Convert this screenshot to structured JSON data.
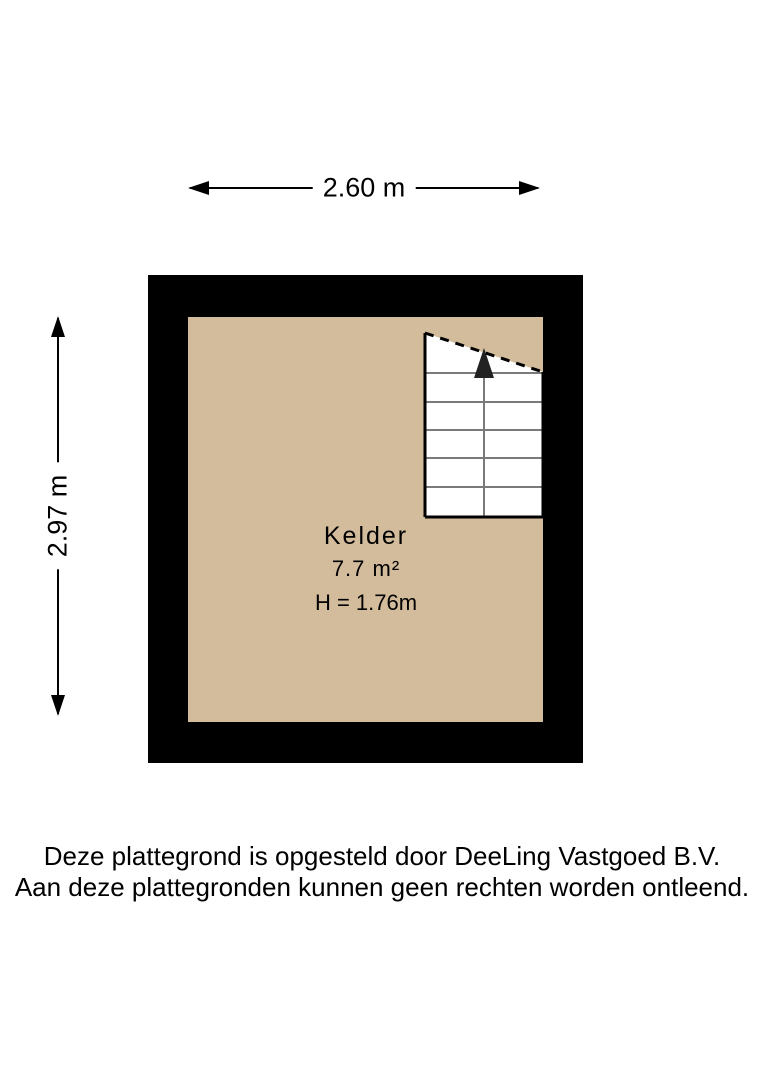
{
  "dimensions": {
    "width_label": "2.60 m",
    "height_label": "2.97 m"
  },
  "room": {
    "name": "Kelder",
    "area": "7.7 m²",
    "ceiling_height": "H = 1.76m"
  },
  "stairs": {
    "direction": "up",
    "step_count": 6
  },
  "footer": {
    "line1": "Deze plattegrond is opgesteld door DeeLing Vastgoed B.V.",
    "line2": "Aan deze plattegronden kunnen geen rechten worden ontleend."
  },
  "colors": {
    "wall": "#000000",
    "floor": "#d2bc9b",
    "background": "#ffffff",
    "stair_lines": "#7a7a7a",
    "text": "#000000"
  }
}
